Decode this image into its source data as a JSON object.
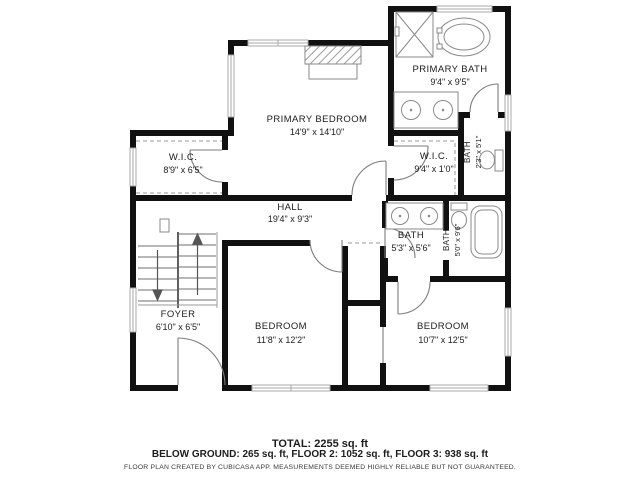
{
  "plan": {
    "rooms": [
      {
        "name": "PRIMARY BATH",
        "dims": "9'4\" x 9'5\""
      },
      {
        "name": "PRIMARY BEDROOM",
        "dims": "14'9\" x 14'10\""
      },
      {
        "name": "W.I.C.",
        "dims": "8'9\" x 6'5\""
      },
      {
        "name": "W.I.C.",
        "dims": "9'4\" x 1'0\""
      },
      {
        "name": "BATH",
        "dims": "2'3\" x 5'1\""
      },
      {
        "name": "HALL",
        "dims": "19'4\" x 9'3\""
      },
      {
        "name": "BATH",
        "dims": "5'3\" x 5'6\""
      },
      {
        "name": "BATH",
        "dims": "5'0\" x 9'6\""
      },
      {
        "name": "FOYER",
        "dims": "6'10\" x 6'5\""
      },
      {
        "name": "BEDROOM",
        "dims": "11'8\" x 12'2\""
      },
      {
        "name": "BEDROOM",
        "dims": "10'7\" x 12'5\""
      }
    ],
    "footer": {
      "total": "TOTAL: 2255 sq. ft",
      "breakdown": "BELOW GROUND: 265 sq. ft, FLOOR 2: 1052 sq. ft, FLOOR 3: 938 sq. ft",
      "disclaimer": "FLOOR PLAN CREATED BY CUBICASA APP. MEASUREMENTS DEEMED HIGHLY RELIABLE BUT NOT GUARANTEED."
    },
    "colors": {
      "wall": "#111111",
      "fixture": "#8a8a8a",
      "text": "#1c1c1c",
      "background": "#ffffff"
    }
  }
}
